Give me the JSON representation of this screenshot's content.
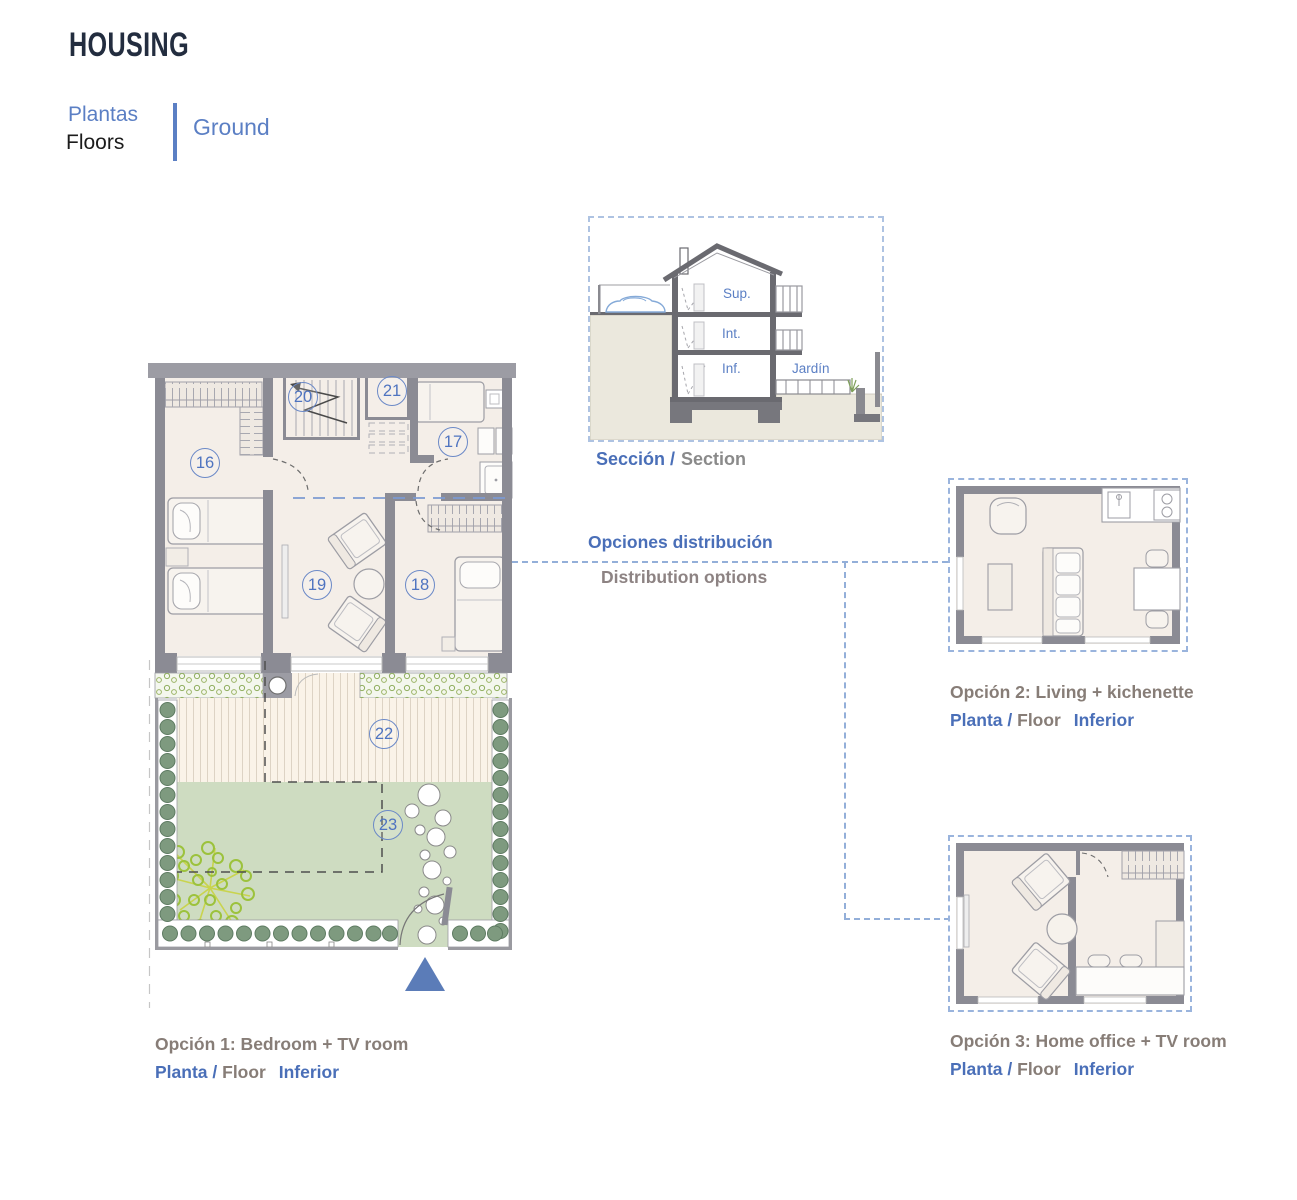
{
  "header": {
    "title": "HOUSING",
    "tagline_es": "Plantas",
    "tagline_en": "Floors",
    "floor_tab": "Ground"
  },
  "section_view": {
    "caption_es": "Sección /",
    "caption_en": "Section",
    "floor_labels": {
      "upper": "Sup.",
      "middle": "Int.",
      "lower": "Inf.",
      "garden": "Jardín"
    }
  },
  "distribution": {
    "title_es": "Opciones distribución",
    "title_en": "Distribution options"
  },
  "main_plan": {
    "room_numbers": [
      "16",
      "20",
      "21",
      "17",
      "19",
      "18",
      "22",
      "23"
    ]
  },
  "options": [
    {
      "title": "Opción 1: Bedroom + TV room",
      "floor_es": "Planta /",
      "floor_en": "Floor",
      "floor_level": "Inferior"
    },
    {
      "title": "Opción 2: Living + kichenette",
      "floor_es": "Planta /",
      "floor_en": "Floor",
      "floor_level": "Inferior"
    },
    {
      "title": "Opción 3: Home office + TV room",
      "floor_es": "Planta /",
      "floor_en": "Floor",
      "floor_level": "Inferior"
    }
  ],
  "colors": {
    "accent_blue": "#4a6fb8",
    "light_blue": "#5b7fc4",
    "title_navy": "#232d3f",
    "caption_gray": "#877d77",
    "wall_gray": "#8b8b94",
    "floor_beige": "#f4eee8",
    "lawn_green": "#cedcc1",
    "deck_cream": "#faf3e8",
    "tree_green": "#9cc23c",
    "shrub_green": "#7e9a7f",
    "marker_blue": "#5b7cb8",
    "dash_blue": "#93afd9"
  }
}
